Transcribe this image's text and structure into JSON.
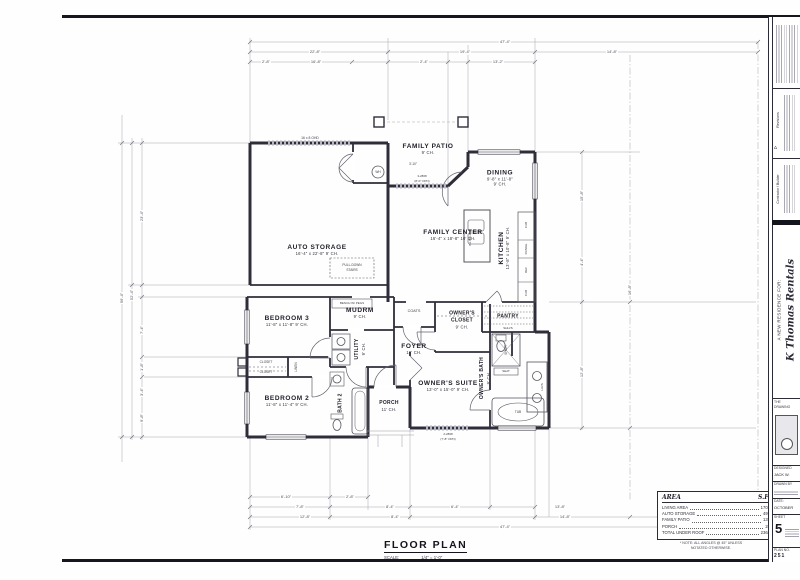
{
  "sheet": {
    "title": "FLOOR PLAN",
    "scale_label": "SCALE:",
    "scale_value": "1/4\" = 1'-0\"",
    "note_line1": "* NOTE:  ALL ANGLES @ 45° UNLESS",
    "note_line2": "NOTATED OTHERWISE."
  },
  "area_table": {
    "header": {
      "name": "AREA",
      "unit": "S.F."
    },
    "rows": [
      {
        "label": "LIVING AREA",
        "value": "1702"
      },
      {
        "label": "AUTO STORAGE",
        "value": "497"
      },
      {
        "label": "FAMILY PATIO",
        "value": "137"
      },
      {
        "label": "PORCH",
        "value": "28"
      },
      {
        "label": "TOTAL UNDER ROOF",
        "value": "2364"
      }
    ]
  },
  "rooms": {
    "auto_storage": {
      "name": "AUTO STORAGE",
      "dims": "16'-4\" x 22'-8\"   9' CH."
    },
    "family_patio": {
      "name": "FAMILY PATIO",
      "ch": "9' CH."
    },
    "dining": {
      "name": "DINING",
      "dims": "9'-8\" x 11'-8\"",
      "ch": "9' CH."
    },
    "family_center": {
      "name": "FAMILY CENTER",
      "dims": "16'-4\" x 18'-8\"   10' CH."
    },
    "kitchen": {
      "name": "KITCHEN",
      "dims": "13'-8\" x 10'-8\"   9' CH."
    },
    "pantry": {
      "name": "PANTRY"
    },
    "bedroom3": {
      "name": "BEDROOM 3",
      "dims": "11'-8\" x 11'-8\"   9' CH."
    },
    "mudrm": {
      "name": "MUDRM",
      "ch": "9' CH."
    },
    "utility": {
      "name": "UTILITY",
      "ch": "9' CH."
    },
    "foyer": {
      "name": "FOYER",
      "ch": "10' CH."
    },
    "owners_closet": {
      "name": "OWNER'S CLOSET",
      "ch": "9' CH."
    },
    "owners_suite": {
      "name": "OWNER'S SUITE",
      "dims": "13'-0\" x 15'-0\"   9' CH."
    },
    "owners_bath": {
      "name": "OWNER'S BATH",
      "ch": "9' CH."
    },
    "bedroom2": {
      "name": "BEDROOM 2",
      "dims": "11'-8\" x 11'-4\"   9' CH."
    },
    "bath2": {
      "name": "BATH 2"
    },
    "porch": {
      "name": "PORCH",
      "ch": "11' CH."
    }
  },
  "fixtures": {
    "wh": "WH",
    "pulldown_line1": "PULL-DOWN",
    "pulldown_line2": "STAIRS",
    "bench": "BENCH W/ PEGS",
    "coats": "COATS",
    "linen": "LINEN",
    "closet": "CLOSET",
    "shelves": "SHLVS",
    "island": "ISL BELOW",
    "range": "RANGE",
    "ref": "REF",
    "cab": "CAB",
    "shower": "SHWR",
    "seat": "SEAT",
    "tub": "TUB",
    "lavs": "LAVS",
    "garage_door": "16 x 8 OHD",
    "patio_door": "3-2868",
    "patio_door_opening": "(8'-0\" OPN)",
    "suite_window": "2-2868",
    "suite_window_opening": "(7'-8\" OPN)",
    "patio_depth": "3'-10\""
  },
  "dims": {
    "top": [
      "47'-4\"",
      "22'-8\"",
      "19'-4\"",
      "2'-8\"",
      "16'-8\"",
      "2'-4\"",
      "13'-2\"",
      "14'-8\""
    ],
    "left": [
      "56'-4\"",
      "52'-4\"",
      "23'-4\"",
      "7'-4\"",
      "1'-8\"",
      "3'-4\"",
      "9'-8\""
    ],
    "right": [
      "15'-8\"",
      "4'-4\"",
      "12'-8\"",
      "16'-8\""
    ],
    "bottom": [
      "6'-10\"",
      "2'-8\"",
      "7'-8\"",
      "8'-4\"",
      "6'-4\"",
      "13'-8\"",
      "12'-8\"",
      "8'-4\"",
      "14'-8\"",
      "8'-8\"",
      "47'-4\"",
      "6'-10\""
    ]
  },
  "titleblock": {
    "residence_for": "A NEW RESIDENCE FOR:",
    "client": "K Thomas Rentals",
    "revisions_label": "Revisions",
    "revision_mark": "Δ",
    "contractor_label": "Contractor / Builder",
    "brand_line1": "THE",
    "brand_line2": "DRAWING",
    "designed_label": "DESIGNED",
    "designed_value": "JACK W.",
    "drawn_label": "DRAWN BY",
    "date_label": "DATE:",
    "date_value": "OCTOBER",
    "sheet_label": "SHEET",
    "sheet_number": "5",
    "plan_label": "PLAN NO.",
    "plan_number": "251"
  }
}
